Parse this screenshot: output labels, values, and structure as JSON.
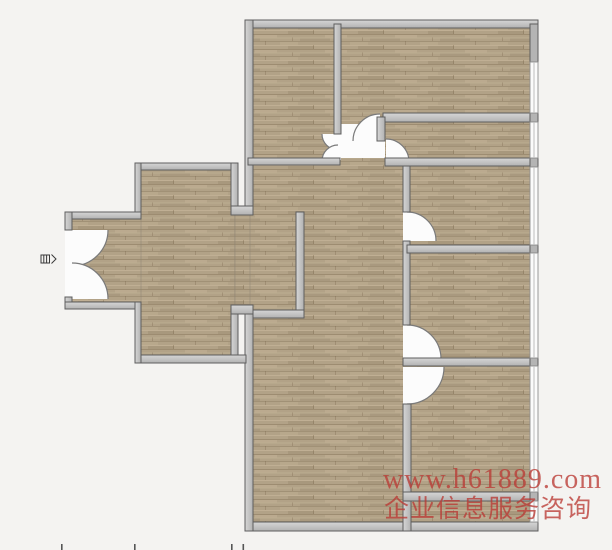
{
  "canvas": {
    "width": 612,
    "height": 550,
    "background": "#f4f3f1"
  },
  "watermark": {
    "line1": "www.h61889.com",
    "line2": "企业信息服务咨询",
    "color": "rgba(186,58,52,0.78)"
  },
  "palette": {
    "wall_stroke": "#5e5e5e",
    "wall_light": "#d6d6d6",
    "wall_dark": "#b2b2b2",
    "block_fill": "#b4b4b4",
    "floor_base": "#b2a287",
    "floor_streak_dark": "#6e5a40",
    "floor_streak_light": "#d8c8ab",
    "door_arc": "#7a7a7a",
    "clear_white": "#fcfcfc",
    "window_fill": "#fbfbfb",
    "window_frame": "#8f8f8f",
    "window_mid": "#bdbdbd",
    "tick": "#555555",
    "icon_stroke": "#3a3a3a"
  },
  "plan": {
    "floors": [
      [
        248,
        24,
        286,
        504,
        "main-floor"
      ],
      [
        138,
        166,
        97,
        192,
        "wing-floor"
      ],
      [
        68,
        216,
        73,
        89,
        "entry-hall-floor"
      ],
      [
        235,
        215,
        15,
        92,
        "passage-floor"
      ]
    ],
    "clears": [
      [
        341,
        124,
        44,
        34,
        "hall-junction-clear"
      ],
      [
        65,
        229,
        7,
        71,
        "entry-door-gap"
      ],
      [
        334,
        134,
        7,
        26,
        "closet-door-gap"
      ],
      [
        403,
        212,
        7,
        29,
        "bedroom2-door-gap"
      ],
      [
        403,
        325,
        7,
        34,
        "bedroom3-door-gap"
      ],
      [
        403,
        367,
        8,
        37,
        "bedroom4-door-gap"
      ]
    ],
    "walls": [
      [
        245,
        20,
        293,
        8,
        "h",
        "main-top-wall"
      ],
      [
        245,
        522,
        293,
        9,
        "h",
        "main-bottom-wall"
      ],
      [
        245,
        20,
        8,
        195,
        "v",
        "main-left-wall-upper"
      ],
      [
        245,
        305,
        8,
        226,
        "v",
        "main-left-wall-lower"
      ],
      [
        135,
        163,
        103,
        7,
        "h",
        "wing-top-wall"
      ],
      [
        231,
        163,
        7,
        46,
        "v",
        "wing-right-wall-upper"
      ],
      [
        231,
        206,
        22,
        9,
        "h",
        "passage-top-block"
      ],
      [
        231,
        305,
        22,
        9,
        "h",
        "passage-bottom-block"
      ],
      [
        231,
        314,
        7,
        45,
        "v",
        "wing-right-wall-lower"
      ],
      [
        135,
        355,
        111,
        8,
        "h",
        "wing-bottom-wall"
      ],
      [
        135,
        163,
        6,
        56,
        "v",
        "wing-left-wall-upper"
      ],
      [
        65,
        212,
        76,
        7,
        "h",
        "entry-top-wall"
      ],
      [
        65,
        212,
        7,
        18,
        "v",
        "entry-left-wall-upper"
      ],
      [
        65,
        297,
        7,
        12,
        "v",
        "entry-left-wall-lower"
      ],
      [
        65,
        302,
        76,
        7,
        "h",
        "entry-bottom-wall"
      ],
      [
        135,
        302,
        6,
        61,
        "v",
        "wing-left-wall-lower"
      ],
      [
        248,
        158,
        92,
        7,
        "h",
        "study-bottom-wall"
      ],
      [
        334,
        24,
        7,
        110,
        "v",
        "bedroom1-left-wall"
      ],
      [
        383,
        113,
        147,
        9,
        "h",
        "corridor-top-wall"
      ],
      [
        377,
        117,
        8,
        24,
        "v",
        "corridor-stub-wall"
      ],
      [
        385,
        158,
        145,
        8,
        "h",
        "corridor-bottom-wall"
      ],
      [
        403,
        166,
        7,
        46,
        "v",
        "right-divider-wall-a"
      ],
      [
        403,
        241,
        7,
        84,
        "v",
        "right-divider-wall-b"
      ],
      [
        407,
        245,
        123,
        8,
        "h",
        "bedroom2-bottom-wall"
      ],
      [
        403,
        358,
        127,
        8,
        "h",
        "bedroom3-bottom-wall"
      ],
      [
        403,
        404,
        8,
        127,
        "v",
        "right-divider-wall-c"
      ],
      [
        403,
        492,
        127,
        9,
        "h",
        "balcony-top-wall"
      ],
      [
        296,
        212,
        8,
        106,
        "v",
        "closet-right-wall"
      ],
      [
        253,
        310,
        51,
        8,
        "h",
        "closet-bottom-wall"
      ]
    ],
    "blocks": [
      [
        530,
        24,
        8,
        38,
        "right-wall-top-pier"
      ],
      [
        530,
        113,
        8,
        9,
        "right-wall-pier-1"
      ],
      [
        530,
        158,
        8,
        9,
        "right-wall-pier-2"
      ],
      [
        530,
        245,
        8,
        8,
        "right-wall-pier-3"
      ],
      [
        530,
        358,
        8,
        8,
        "right-wall-pier-4"
      ],
      [
        530,
        492,
        8,
        9,
        "right-wall-pier-5"
      ]
    ],
    "windows": [
      [
        530,
        62,
        8,
        51,
        "window-bedroom1"
      ],
      [
        530,
        122,
        8,
        36,
        "window-corridor"
      ],
      [
        530,
        167,
        8,
        78,
        "window-bedroom2"
      ],
      [
        530,
        253,
        8,
        105,
        "window-bedroom3"
      ],
      [
        530,
        366,
        8,
        126,
        "window-bedroom4"
      ],
      [
        530,
        501,
        8,
        21,
        "window-balcony"
      ]
    ],
    "doors": [
      [
        72,
        230,
        36,
        0,
        90,
        1,
        "entry-door-top-leaf"
      ],
      [
        72,
        299,
        36,
        0,
        -90,
        0,
        "entry-door-bottom-leaf"
      ],
      [
        338,
        134,
        16,
        180,
        90,
        0,
        "closet-door-top-leaf"
      ],
      [
        338,
        161,
        16,
        180,
        270,
        1,
        "closet-door-bottom-leaf"
      ],
      [
        380,
        141,
        27,
        180,
        270,
        1,
        "bedroom1-door"
      ],
      [
        386,
        162,
        23,
        270,
        360,
        1,
        "corridor-door"
      ],
      [
        407,
        241,
        29,
        270,
        360,
        1,
        "bedroom2-door"
      ],
      [
        407,
        359,
        34,
        270,
        360,
        1,
        "bedroom3-door"
      ],
      [
        407,
        367,
        37,
        0,
        90,
        1,
        "bedroom4-door"
      ]
    ],
    "ticks": [
      [
        61,
        544,
        "dim-tick-1"
      ],
      [
        134,
        544,
        "dim-tick-2"
      ],
      [
        231,
        544,
        "dim-tick-3"
      ],
      [
        242.5,
        544,
        "dim-tick-4"
      ]
    ],
    "entry_icon": {
      "x": 41,
      "y": 255
    }
  }
}
